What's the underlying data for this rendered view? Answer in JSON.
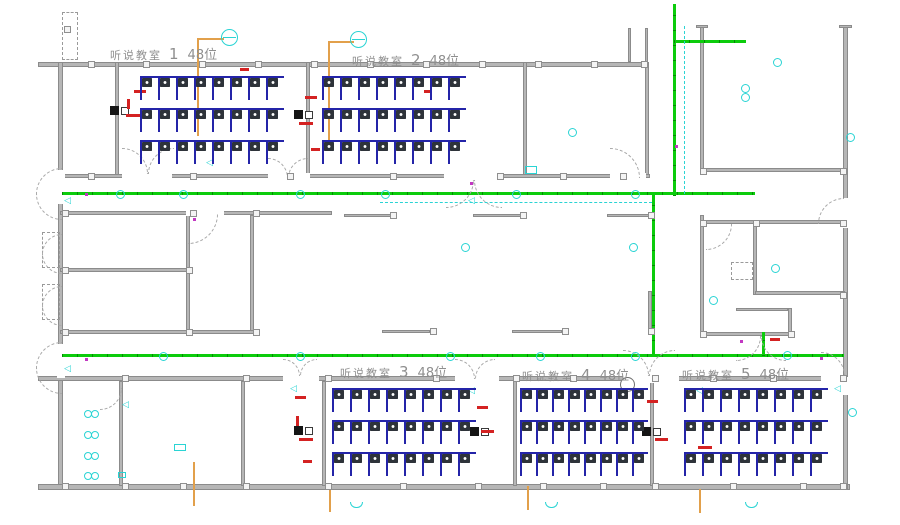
{
  "drawing_type": "classroom-floor-plan-cad",
  "rooms": [
    {
      "name": "听说教室",
      "number": "1",
      "seats": "48位"
    },
    {
      "name": "听说教室",
      "number": "2",
      "seats": "48位"
    },
    {
      "name": "听说教室",
      "number": "3",
      "seats": "48位"
    },
    {
      "name": "听说教室",
      "number": "4",
      "seats": "48位"
    },
    {
      "name": "听说教室",
      "number": "5",
      "seats": "48位"
    }
  ],
  "colors": {
    "green": "#0ccc0c",
    "cyan": "#2ad4d4",
    "orange": "#e2a04b",
    "red": "#d42222",
    "deskblue": "#2424a8",
    "chair": "#2e333a",
    "wall": "#9c9c9c"
  },
  "geometry": {
    "walls": [
      [
        38,
        62,
        610,
        5
      ],
      [
        58,
        62,
        5,
        424
      ],
      [
        38,
        484,
        812,
        6
      ],
      [
        843,
        25,
        5,
        464
      ],
      [
        700,
        25,
        4,
        148
      ],
      [
        702,
        168,
        143,
        4
      ],
      [
        645,
        62,
        4,
        116
      ],
      [
        523,
        62,
        4,
        116
      ],
      [
        115,
        62,
        4,
        116
      ],
      [
        306,
        62,
        4,
        116
      ],
      [
        60,
        174,
        590,
        4
      ],
      [
        60,
        211,
        272,
        4
      ],
      [
        344,
        214,
        48,
        3
      ],
      [
        473,
        214,
        49,
        3
      ],
      [
        607,
        214,
        45,
        3
      ],
      [
        186,
        215,
        4,
        119
      ],
      [
        250,
        215,
        4,
        119
      ],
      [
        60,
        268,
        128,
        4
      ],
      [
        60,
        330,
        196,
        4
      ],
      [
        382,
        330,
        48,
        3
      ],
      [
        512,
        330,
        50,
        3
      ],
      [
        648,
        291,
        4,
        43
      ],
      [
        700,
        215,
        4,
        121
      ],
      [
        702,
        220,
        143,
        4
      ],
      [
        753,
        220,
        4,
        75
      ],
      [
        755,
        291,
        90,
        4
      ],
      [
        702,
        332,
        90,
        4
      ],
      [
        788,
        308,
        4,
        28
      ],
      [
        736,
        308,
        52,
        3
      ],
      [
        38,
        376,
        810,
        5
      ],
      [
        119,
        381,
        4,
        105
      ],
      [
        241,
        381,
        4,
        105
      ],
      [
        322,
        381,
        4,
        105
      ],
      [
        513,
        381,
        4,
        105
      ],
      [
        650,
        381,
        4,
        105
      ],
      [
        628,
        28,
        3,
        34
      ],
      [
        645,
        28,
        3,
        34
      ],
      [
        696,
        25,
        12,
        3
      ],
      [
        839,
        25,
        13,
        3
      ]
    ],
    "wall_gaps": [
      [
        122,
        173,
        50,
        7
      ],
      [
        268,
        173,
        42,
        7
      ],
      [
        444,
        173,
        58,
        7
      ],
      [
        610,
        173,
        36,
        7
      ],
      [
        186,
        210,
        38,
        6
      ],
      [
        283,
        375,
        36,
        8
      ],
      [
        455,
        375,
        44,
        8
      ],
      [
        623,
        375,
        56,
        8
      ],
      [
        821,
        375,
        24,
        8
      ],
      [
        57,
        170,
        8,
        34
      ],
      [
        57,
        344,
        8,
        34
      ],
      [
        842,
        377,
        8,
        18
      ],
      [
        842,
        198,
        8,
        30
      ]
    ],
    "green_lines": [
      [
        673,
        4,
        3,
        192
      ],
      [
        674,
        40,
        72,
        3
      ],
      [
        62,
        192,
        693,
        3
      ],
      [
        652,
        194,
        3,
        162
      ],
      [
        62,
        354,
        782,
        3
      ],
      [
        762,
        332,
        3,
        24
      ]
    ],
    "orange_lines": [
      [
        198,
        38,
        26,
        2
      ],
      [
        197,
        38,
        2,
        98
      ],
      [
        329,
        41,
        25,
        2
      ],
      [
        328,
        41,
        2,
        108
      ],
      [
        193,
        462,
        2,
        44
      ],
      [
        329,
        486,
        2,
        26
      ],
      [
        527,
        486,
        2,
        24
      ],
      [
        699,
        489,
        2,
        24
      ]
    ],
    "cyan_dashed": [
      [
        684,
        26,
        1,
        168
      ],
      [
        380,
        202,
        272,
        1
      ]
    ],
    "arcs": [
      [
        122,
        148,
        26,
        "tr"
      ],
      [
        148,
        148,
        26,
        "tl"
      ],
      [
        268,
        158,
        20,
        "tr"
      ],
      [
        288,
        158,
        20,
        "tl"
      ],
      [
        446,
        180,
        28,
        "br"
      ],
      [
        474,
        180,
        28,
        "bl"
      ],
      [
        610,
        148,
        30,
        "tr"
      ],
      [
        188,
        214,
        30,
        "br"
      ],
      [
        283,
        359,
        17,
        "tr"
      ],
      [
        300,
        359,
        17,
        "tl"
      ],
      [
        455,
        359,
        20,
        "tr"
      ],
      [
        475,
        359,
        20,
        "tl"
      ],
      [
        623,
        350,
        26,
        "tr"
      ],
      [
        649,
        350,
        26,
        "tl"
      ],
      [
        821,
        352,
        24,
        "tr"
      ],
      [
        736,
        336,
        25,
        "br"
      ],
      [
        761,
        336,
        25,
        "bl"
      ],
      [
        100,
        388,
        22,
        "br"
      ],
      [
        706,
        224,
        26,
        "br"
      ],
      [
        818,
        198,
        26,
        "tl"
      ],
      [
        36,
        168,
        26,
        "tl"
      ],
      [
        36,
        194,
        26,
        "bl"
      ],
      [
        36,
        342,
        26,
        "tl"
      ],
      [
        36,
        368,
        26,
        "bl"
      ],
      [
        42,
        234,
        20,
        "tl"
      ],
      [
        42,
        254,
        20,
        "bl"
      ],
      [
        42,
        286,
        20,
        "tl"
      ],
      [
        42,
        306,
        20,
        "bl"
      ]
    ],
    "columns": [
      [
        88,
        61
      ],
      [
        143,
        61
      ],
      [
        199,
        61
      ],
      [
        255,
        61
      ],
      [
        311,
        61
      ],
      [
        367,
        61
      ],
      [
        423,
        61
      ],
      [
        479,
        61
      ],
      [
        535,
        61
      ],
      [
        591,
        61
      ],
      [
        641,
        61
      ],
      [
        88,
        173
      ],
      [
        190,
        173
      ],
      [
        287,
        173
      ],
      [
        390,
        173
      ],
      [
        497,
        173
      ],
      [
        560,
        173
      ],
      [
        620,
        173
      ],
      [
        62,
        210
      ],
      [
        190,
        210
      ],
      [
        253,
        210
      ],
      [
        390,
        212
      ],
      [
        520,
        212
      ],
      [
        648,
        212
      ],
      [
        62,
        267
      ],
      [
        186,
        267
      ],
      [
        62,
        329
      ],
      [
        186,
        329
      ],
      [
        253,
        329
      ],
      [
        430,
        328
      ],
      [
        562,
        328
      ],
      [
        648,
        328
      ],
      [
        122,
        375
      ],
      [
        243,
        375
      ],
      [
        325,
        375
      ],
      [
        433,
        375
      ],
      [
        513,
        375
      ],
      [
        570,
        375
      ],
      [
        652,
        375
      ],
      [
        710,
        375
      ],
      [
        770,
        375
      ],
      [
        840,
        375
      ],
      [
        62,
        483
      ],
      [
        122,
        483
      ],
      [
        180,
        483
      ],
      [
        243,
        483
      ],
      [
        325,
        483
      ],
      [
        400,
        483
      ],
      [
        475,
        483
      ],
      [
        540,
        483
      ],
      [
        600,
        483
      ],
      [
        652,
        483
      ],
      [
        730,
        483
      ],
      [
        800,
        483
      ],
      [
        840,
        483
      ],
      [
        700,
        168
      ],
      [
        840,
        168
      ],
      [
        700,
        220
      ],
      [
        753,
        220
      ],
      [
        840,
        220
      ],
      [
        700,
        331
      ],
      [
        788,
        331
      ],
      [
        840,
        292
      ],
      [
        64,
        26
      ]
    ],
    "dashed_rects": [
      [
        62,
        12,
        16,
        48
      ],
      [
        42,
        232,
        18,
        36
      ],
      [
        42,
        284,
        18,
        36
      ],
      [
        731,
        262,
        22,
        18
      ]
    ],
    "clocks": [
      [
        221,
        29
      ],
      [
        350,
        31
      ]
    ],
    "circles": [
      [
        120,
        194
      ],
      [
        183,
        194
      ],
      [
        300,
        194
      ],
      [
        385,
        194
      ],
      [
        516,
        194
      ],
      [
        635,
        194
      ],
      [
        163,
        356
      ],
      [
        300,
        356
      ],
      [
        450,
        356
      ],
      [
        540,
        356
      ],
      [
        635,
        356
      ],
      [
        787,
        355
      ],
      [
        572,
        132
      ],
      [
        745,
        88
      ],
      [
        745,
        97
      ],
      [
        777,
        62
      ],
      [
        850,
        137
      ],
      [
        465,
        247
      ],
      [
        633,
        247
      ],
      [
        775,
        268
      ],
      [
        713,
        300
      ],
      [
        852,
        412
      ]
    ],
    "gray_circles": [
      [
        620,
        377
      ]
    ],
    "triangles": [
      [
        206,
        158
      ],
      [
        468,
        196
      ],
      [
        122,
        400
      ],
      [
        290,
        384
      ],
      [
        468,
        386
      ],
      [
        696,
        386
      ],
      [
        834,
        384
      ],
      [
        64,
        196
      ],
      [
        64,
        364
      ]
    ],
    "magenta_dots": [
      [
        85,
        193
      ],
      [
        85,
        358
      ],
      [
        193,
        218
      ],
      [
        470,
        182
      ],
      [
        675,
        145
      ],
      [
        740,
        340
      ],
      [
        820,
        357
      ]
    ],
    "panels": [
      [
        110,
        106
      ],
      [
        294,
        110
      ],
      [
        294,
        426
      ],
      [
        470,
        427
      ],
      [
        642,
        427
      ]
    ],
    "basins": [
      [
        84,
        410
      ],
      [
        84,
        431
      ],
      [
        84,
        452
      ],
      [
        84,
        472
      ]
    ],
    "cyan_rects": [
      [
        174,
        444,
        12,
        7
      ],
      [
        525,
        166,
        12,
        8
      ],
      [
        118,
        472,
        8,
        6
      ]
    ],
    "cyan_arcs": [
      [
        350,
        502
      ],
      [
        545,
        502
      ],
      [
        745,
        502
      ]
    ],
    "red_marks": [
      [
        134,
        90,
        12,
        3
      ],
      [
        126,
        114,
        14,
        3
      ],
      [
        140,
        146,
        9,
        3
      ],
      [
        127,
        99,
        3,
        10
      ],
      [
        305,
        96,
        12,
        3
      ],
      [
        299,
        122,
        14,
        3
      ],
      [
        311,
        148,
        9,
        3
      ],
      [
        240,
        68,
        9,
        3
      ],
      [
        424,
        90,
        8,
        3
      ],
      [
        296,
        416,
        3,
        10
      ],
      [
        299,
        438,
        14,
        3
      ],
      [
        303,
        460,
        9,
        3
      ],
      [
        295,
        396,
        11,
        3
      ],
      [
        477,
        406,
        11,
        3
      ],
      [
        481,
        430,
        13,
        3
      ],
      [
        647,
        400,
        11,
        3
      ],
      [
        655,
        438,
        13,
        3
      ],
      [
        698,
        446,
        14,
        3
      ],
      [
        770,
        338,
        10,
        3
      ]
    ],
    "desk_blocks": [
      {
        "x": 140,
        "y": 76,
        "pitch": 18
      },
      {
        "x": 322,
        "y": 76,
        "pitch": 18
      },
      {
        "x": 332,
        "y": 388,
        "pitch": 18
      },
      {
        "x": 520,
        "y": 388,
        "pitch": 16
      },
      {
        "x": 684,
        "y": 388,
        "pitch": 18
      }
    ],
    "desk_config": {
      "rows": 3,
      "cols": 8,
      "row_step": 32,
      "row_h": 24
    }
  }
}
